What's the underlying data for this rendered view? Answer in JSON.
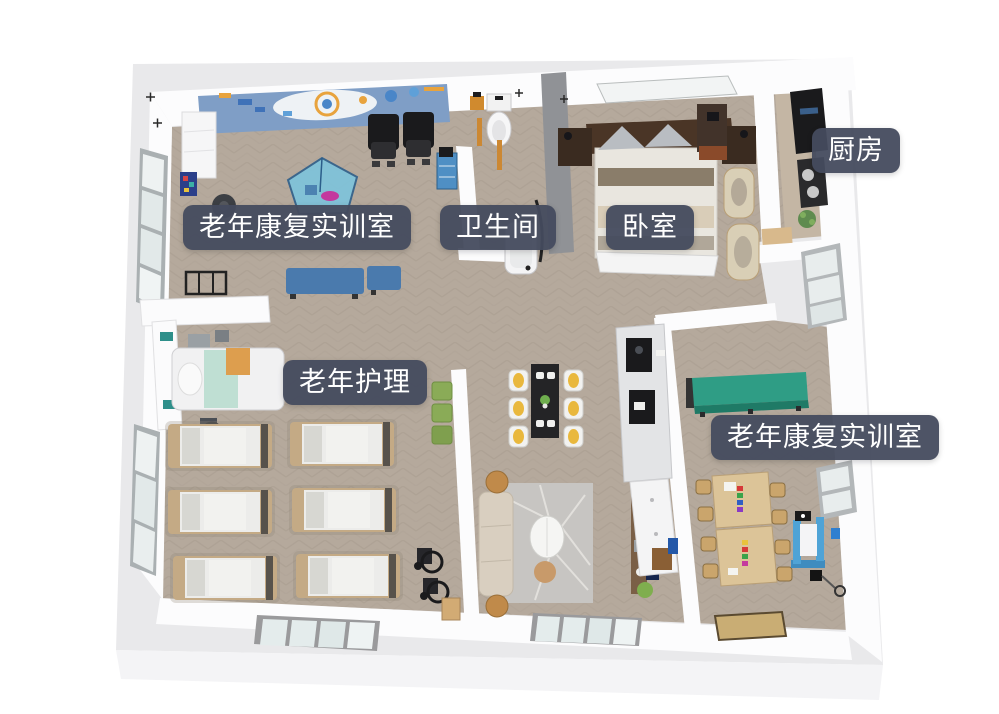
{
  "scene": {
    "type": "3d-floor-plan",
    "description": "Top-down 3D rendering of an elderly care training facility",
    "background_color": "#ffffff"
  },
  "labels": [
    {
      "id": "rehab-room-1",
      "text": "老年康复实训室"
    },
    {
      "id": "bathroom",
      "text": "卫生间"
    },
    {
      "id": "bedroom",
      "text": "卧室"
    },
    {
      "id": "kitchen",
      "text": "厨房"
    },
    {
      "id": "nursing",
      "text": "老年护理"
    },
    {
      "id": "rehab-room-2",
      "text": "老年康复实训室"
    }
  ],
  "rooms": [
    {
      "name": "老年康复实训室",
      "area": "upper-left",
      "items": [
        "wall-mural",
        "massage-chairs",
        "balance-training-mat",
        "treatment-benches",
        "walker",
        "supply-cabinet",
        "office-chair"
      ]
    },
    {
      "name": "卫生间",
      "area": "top-middle",
      "items": [
        "toilet",
        "bathtub",
        "grab-bar",
        "supply-cart"
      ]
    },
    {
      "name": "卧室",
      "area": "top-right",
      "items": [
        "double-bed",
        "nightstands",
        "dresser",
        "floor-mats",
        "glass-panel"
      ]
    },
    {
      "name": "厨房",
      "area": "far-right",
      "items": [
        "refrigerator",
        "cooktop",
        "counter",
        "plant"
      ]
    },
    {
      "name": "老年护理",
      "area": "middle-left",
      "items": [
        "nurse-counter",
        "hospital-bed",
        "care-beds-x6",
        "green-stools",
        "wheelchairs"
      ]
    },
    {
      "name": "老年康复实训室",
      "area": "lower-right",
      "items": [
        "training-table",
        "equipment-shelf",
        "activity-tables",
        "activity-chairs",
        "rehab-machine",
        "doormat"
      ]
    },
    {
      "name": "living-dining",
      "area": "center",
      "items": [
        "dining-table",
        "dining-chairs-x6",
        "sofa",
        "area-rug",
        "pendant-lamp",
        "tv-console",
        "tv"
      ]
    }
  ],
  "palette": {
    "label_bg": "#444b5e",
    "label_text": "#ffffff",
    "plate": "#e9e9eb",
    "plate_side": "#f4f4f6",
    "wall": "#fcfcfd",
    "wall_dark": "#909296",
    "floor": "#b5a99c",
    "floor_light": "#c4b6a4",
    "mural_blue": "#7f9ec6",
    "mural_accent": "#e8a33d",
    "bench_blue": "#4a7aad",
    "mat_blue": "#7cc5de",
    "mint": "#bfdfd3",
    "orange_throw": "#dd9e4e",
    "bed_frame_tan": "#c4aa85",
    "bedding_white": "#ececea",
    "stool_green": "#8aab57",
    "chair_yellow": "#e9b83d",
    "table_black": "#242426",
    "sofa_beige": "#d9cfc0",
    "rug_gray": "#c7c5c2",
    "wood": "#c08a4a",
    "console_brown": "#7a5f46",
    "tv_blue": "#16264d",
    "teal_table": "#2f9d85",
    "activity_wood": "#dcc498",
    "rehab_blue": "#4fa3d6",
    "dark_equipment": "#1a1a1c",
    "glass": "#e4ecec",
    "window_frame": "#9aa0a3",
    "doormat": "#c9ad74",
    "headboard_brown": "#4a3526"
  }
}
